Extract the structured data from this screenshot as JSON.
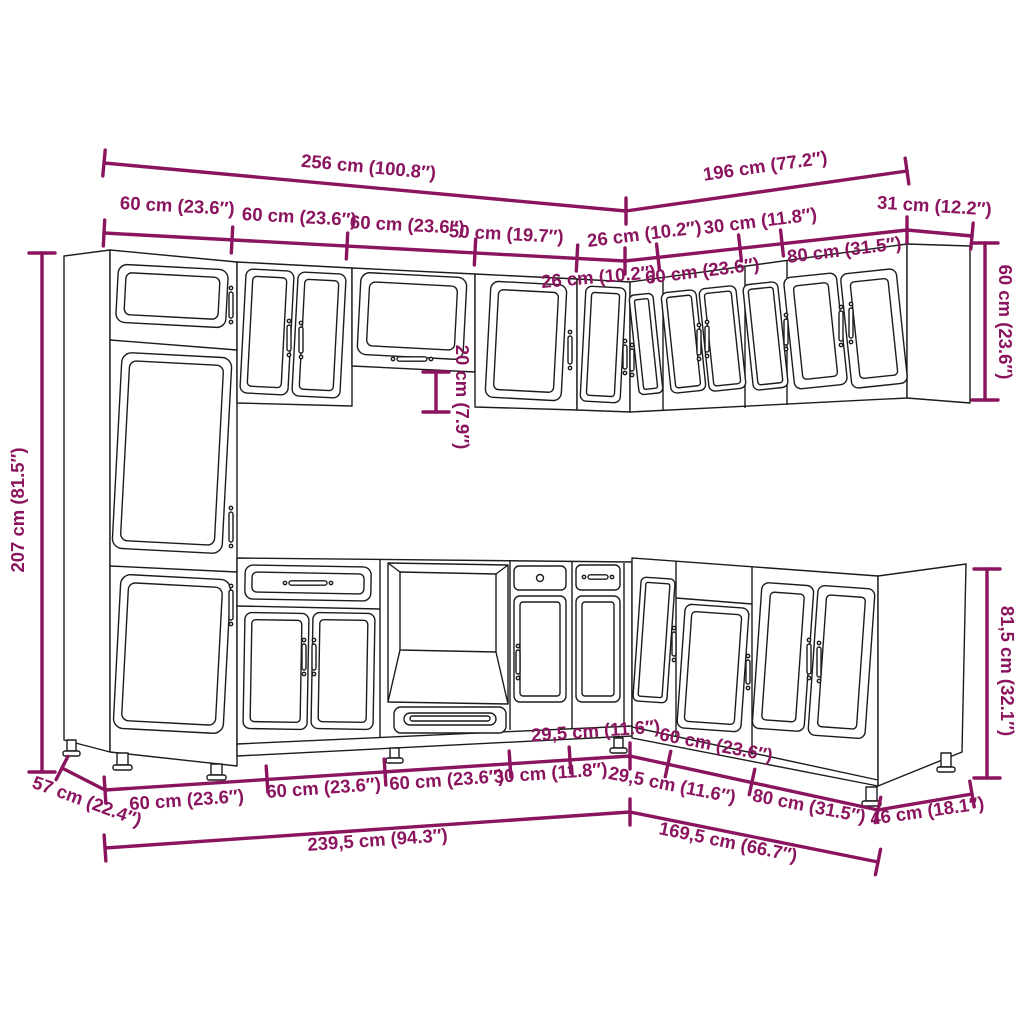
{
  "colors": {
    "dimension": "#8b145f",
    "cabinet_line": "#1c1c1c",
    "background": "#ffffff"
  },
  "dims": {
    "run_left_total": "256 cm (100.8″)",
    "run_right_total": "196 cm (77.2″)",
    "wall_60_a": "60 cm (23.6″)",
    "wall_60_b": "60 cm (23.6″)",
    "wall_60_c": "60 cm (23.6″)",
    "wall_50": "50 cm (19.7″)",
    "wall_26_left": "26 cm (10.2″)",
    "wall_26_right": "26 cm (10.2″)",
    "wall_60_right": "60 cm (23.6″)",
    "wall_30": "30 cm (11.8″)",
    "wall_80": "80 cm (31.5″)",
    "wall_depth": "31 cm (12.2″)",
    "wall_height_right": "60 cm (23.6″)",
    "tall_height": "207 cm (81.5″)",
    "wall_gap": "20 cm (7.9″)",
    "base_height_right": "81,5 cm (32.1″)",
    "base_depth_left": "57 cm (22.4″)",
    "base_60_a": "60 cm (23.6″)",
    "base_60_b": "60 cm (23.6″)",
    "base_60_c": "60 cm (23.6″)",
    "base_30": "30 cm (11.8″)",
    "base_295_left": "29,5 cm (11.6″)",
    "base_295_right": "29,5 cm (11.6″)",
    "base_60_right": "60 cm (23.6″)",
    "base_80": "80 cm (31.5″)",
    "base_depth_right": "46 cm (18.1″)",
    "base_total_left": "239,5 cm (94.3″)",
    "base_total_right": "169,5 cm (66.7″)"
  }
}
